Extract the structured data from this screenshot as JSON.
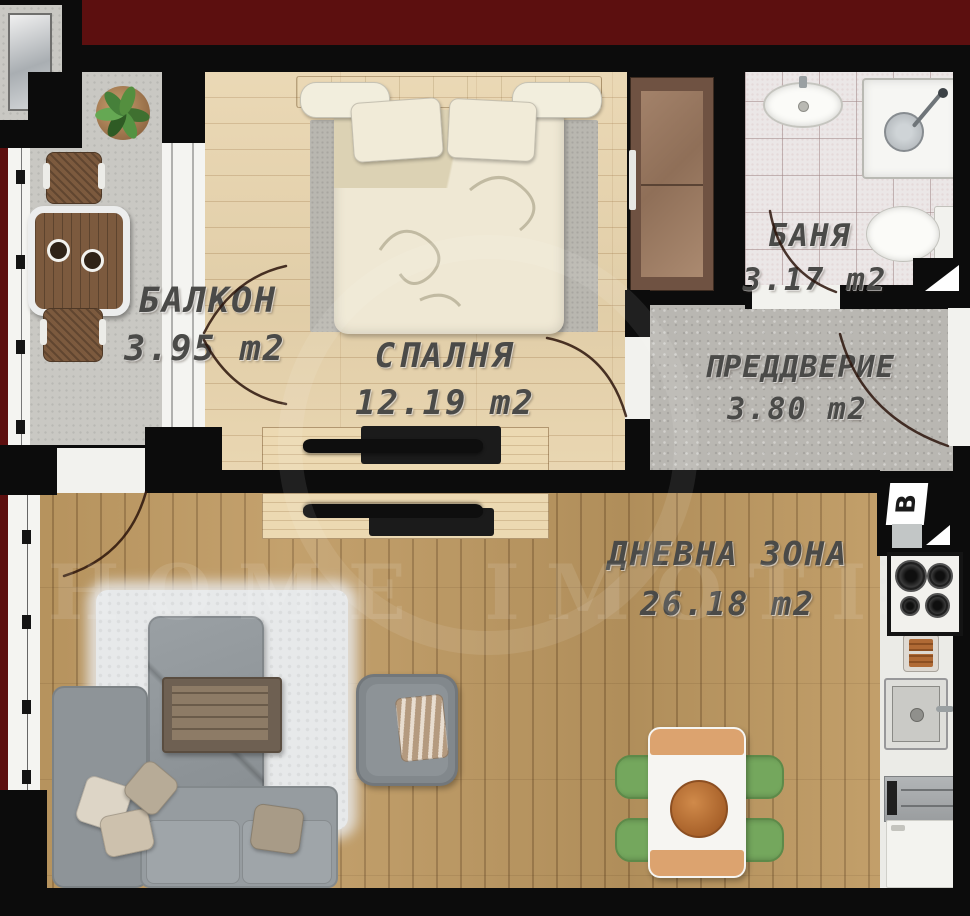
{
  "meta": {
    "title": "Apartment floor plan"
  },
  "rooms": {
    "balcony": {
      "label": "БАЛКОН",
      "area": "3.95 m2"
    },
    "bedroom": {
      "label": "СПАЛНЯ",
      "area": "12.19 m2"
    },
    "bathroom": {
      "label": "БАНЯ",
      "area": "3.17 m2"
    },
    "hallway": {
      "label": "ПРЕДДВЕРИЕ",
      "area": "3.80 m2"
    },
    "living": {
      "label": "ДНЕВНА ЗОНА",
      "area": "26.18 m2"
    }
  },
  "kitchen": {
    "boiler_label": "B"
  },
  "watermark": {
    "text": "HOME IMOTI"
  },
  "colors": {
    "top_band": "#5c0f0f",
    "walls": "#0c0c0c",
    "bedroom_floor": "#e8d4ad",
    "living_floor": "#bf9a62",
    "balcony_floor": "#c9c8c3",
    "hallway_floor": "#b9b7b2",
    "bathroom_tile": "#ebe7e7",
    "label_text": "#4a4a48",
    "dining_chair_green": "#74a75d",
    "sofa_gray": "#8e9498"
  }
}
